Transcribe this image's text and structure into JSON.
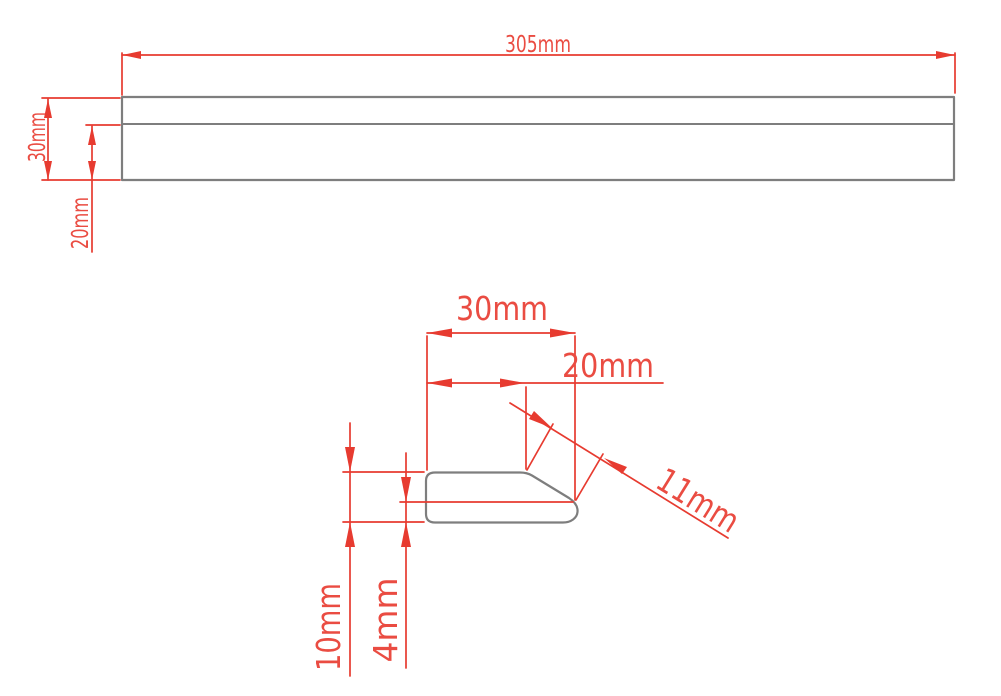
{
  "drawing": {
    "background_color": "#ffffff",
    "dimension_color": "#e73b30",
    "outline_color": "#7e7e7e",
    "side_view": {
      "length_label": "305mm",
      "height_label": "30mm",
      "lower_height_label": "20mm"
    },
    "profile_view": {
      "width_label": "30mm",
      "flat_width_label": "20mm",
      "bevel_length_label": "11mm",
      "thickness_label": "10mm",
      "tip_thickness_label": "4mm"
    }
  }
}
